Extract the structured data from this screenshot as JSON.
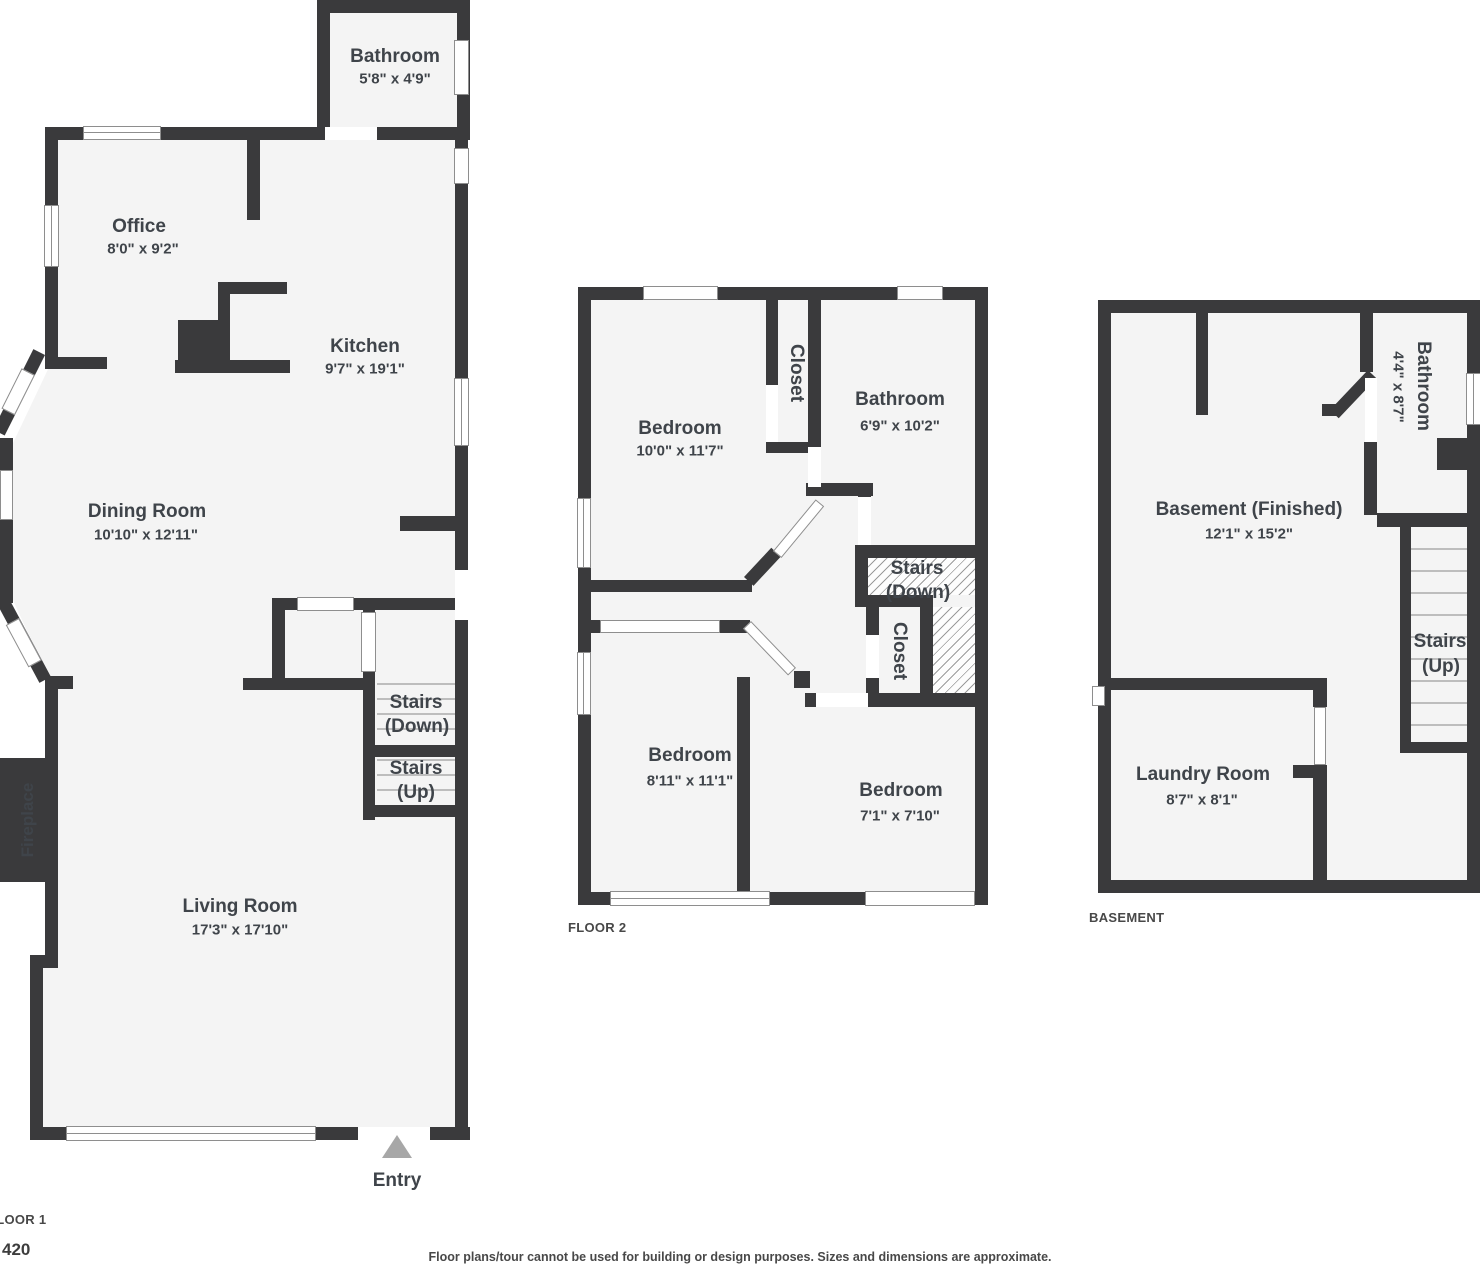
{
  "page": {
    "disclaimer": "Floor plans/tour cannot be used for building or design purposes. Sizes and dimensions are approximate.",
    "unit_number": "420"
  },
  "floor1": {
    "label": "FLOOR 1",
    "entry_label": "Entry",
    "fireplace_label": "Fireplace",
    "rooms": {
      "bathroom": {
        "name": "Bathroom",
        "dims": "5'8\" x 4'9\""
      },
      "office": {
        "name": "Office",
        "dims": "8'0\" x 9'2\""
      },
      "kitchen": {
        "name": "Kitchen",
        "dims": "9'7\" x 19'1\""
      },
      "dining": {
        "name": "Dining Room",
        "dims": "10'10\" x 12'11\""
      },
      "living": {
        "name": "Living Room",
        "dims": "17'3\" x 17'10\""
      }
    },
    "stairs_down": {
      "line1": "Stairs",
      "line2": "(Down)"
    },
    "stairs_up": {
      "line1": "Stairs",
      "line2": "(Up)"
    }
  },
  "floor2": {
    "label": "FLOOR 2",
    "closet_label": "Closet",
    "closet2_label": "Closet",
    "rooms": {
      "bedroom1": {
        "name": "Bedroom",
        "dims": "10'0\" x 11'7\""
      },
      "bathroom": {
        "name": "Bathroom",
        "dims": "6'9\" x 10'2\""
      },
      "bedroom2": {
        "name": "Bedroom",
        "dims": "8'11\" x 11'1\""
      },
      "bedroom3": {
        "name": "Bedroom",
        "dims": "7'1\" x 7'10\""
      }
    },
    "stairs_down": {
      "line1": "Stairs",
      "line2": "(Down)"
    }
  },
  "basement": {
    "label": "BASEMENT",
    "rooms": {
      "main": {
        "name": "Basement (Finished)",
        "dims": "12'1\" x 15'2\""
      },
      "bathroom": {
        "name": "Bathroom",
        "dims": "4'4\" x 8'7\""
      },
      "laundry": {
        "name": "Laundry Room",
        "dims": "8'7\" x 8'1\""
      }
    },
    "stairs_up": {
      "line1": "Stairs",
      "line2": "(Up)"
    }
  }
}
